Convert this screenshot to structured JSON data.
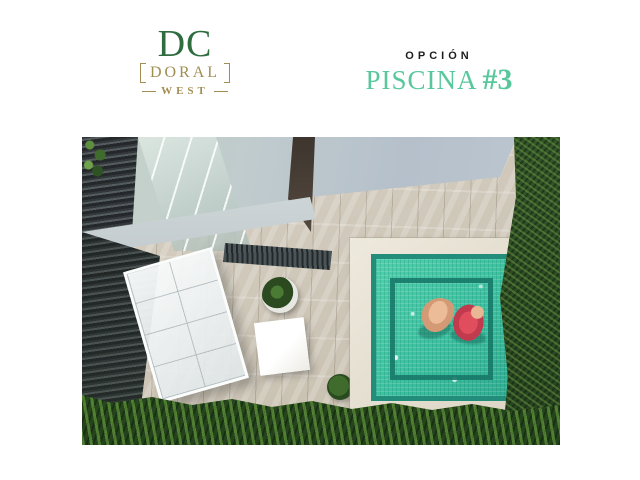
{
  "brand": {
    "initials": "DC",
    "name": "DORAL",
    "suffix": "WEST",
    "green": "#2f6d40",
    "gold": "#a28e52"
  },
  "option": {
    "kicker": "OPCIÓN",
    "title": "PISCINA",
    "number": "#3",
    "accent": "#58c89c"
  },
  "scene": {
    "description": "Aerial 3D rendering of a backyard: square turquoise pool with inner ledge and two people floating, cream stone coping, beige tiled patio, white glass pergola canopy, dark slate stone wall, white square table, round potted plants, dark green hedges along right side and bottom",
    "colors": {
      "pool_water": "#3cc2a0",
      "pool_rim": "#238d7c",
      "pool_coping": "#ece7db",
      "patio_tile": "#d0c8ba",
      "hedge_green": "#2f4c26",
      "roof_gray": "#bcc6d0",
      "slate_wall": "#33383a",
      "pergola_white": "#f4f7f7",
      "swimmer_skin": "#d49a76",
      "swimmer_float_red": "#d84a5a"
    }
  }
}
